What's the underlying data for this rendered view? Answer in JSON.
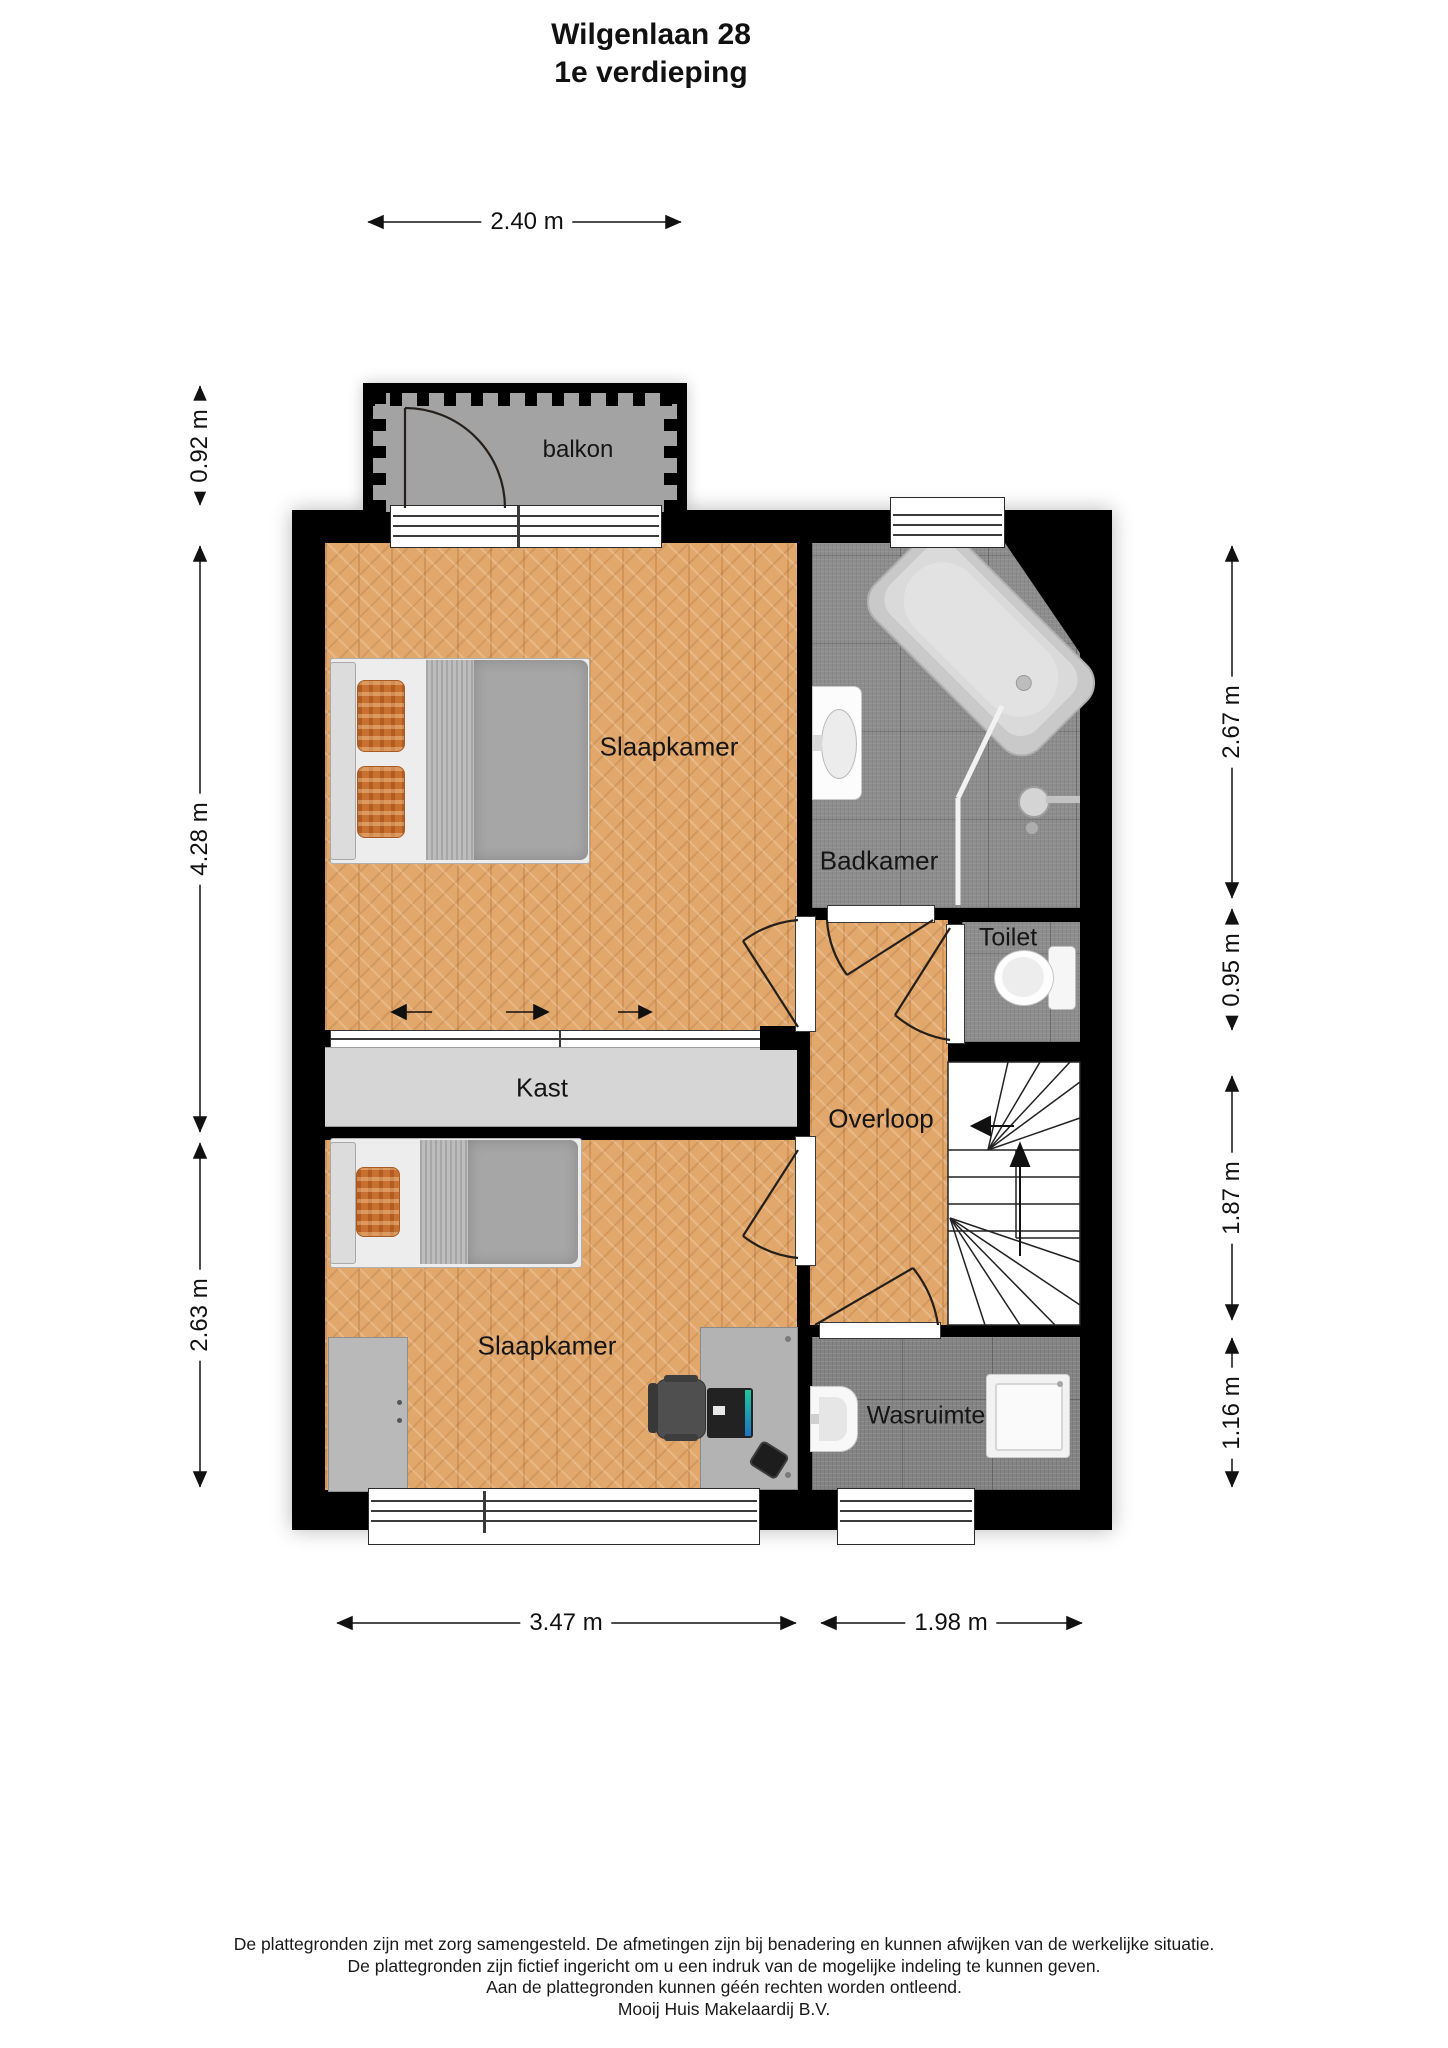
{
  "title": {
    "line1": "Wilgenlaan 28",
    "line2": "1e verdieping"
  },
  "rooms": {
    "balkon": "balkon",
    "slaapkamer_1": "Slaapkamer",
    "badkamer": "Badkamer",
    "toilet": "Toilet",
    "kast": "Kast",
    "overloop": "Overloop",
    "slaapkamer_2": "Slaapkamer",
    "wasruimte": "Wasruimte"
  },
  "dimensions": {
    "top_width": "2.40 m",
    "left_balkon_depth": "0.92 m",
    "left_upper_height": "4.28 m",
    "left_lower_height": "2.63 m",
    "right_badkamer_height": "2.67 m",
    "right_toilet_height": "0.95 m",
    "right_stairs_height": "1.87 m",
    "right_wasruimte_height": "1.16 m",
    "bottom_left_width": "3.47 m",
    "bottom_right_width": "1.98 m"
  },
  "footer": {
    "line1": "De plattegronden zijn met zorg samengesteld. De afmetingen zijn bij benadering en kunnen afwijken van de werkelijke situatie.",
    "line2": "De plattegronden zijn fictief ingericht om u een indruk van de mogelijke indeling te kunnen geven.",
    "line3": "Aan de plattegronden kunnen géén rechten worden ontleend.",
    "line4": "Mooij Huis Makelaardij B.V."
  },
  "colors": {
    "wall": "#000000",
    "parquet": "#e2a76b",
    "tile_gray": "#8d8d8d",
    "kast_gray": "#d6d6d6",
    "balkon_gray": "#a3a3a3",
    "pillow_orange": "#c8702f",
    "label_text": "#111111"
  }
}
